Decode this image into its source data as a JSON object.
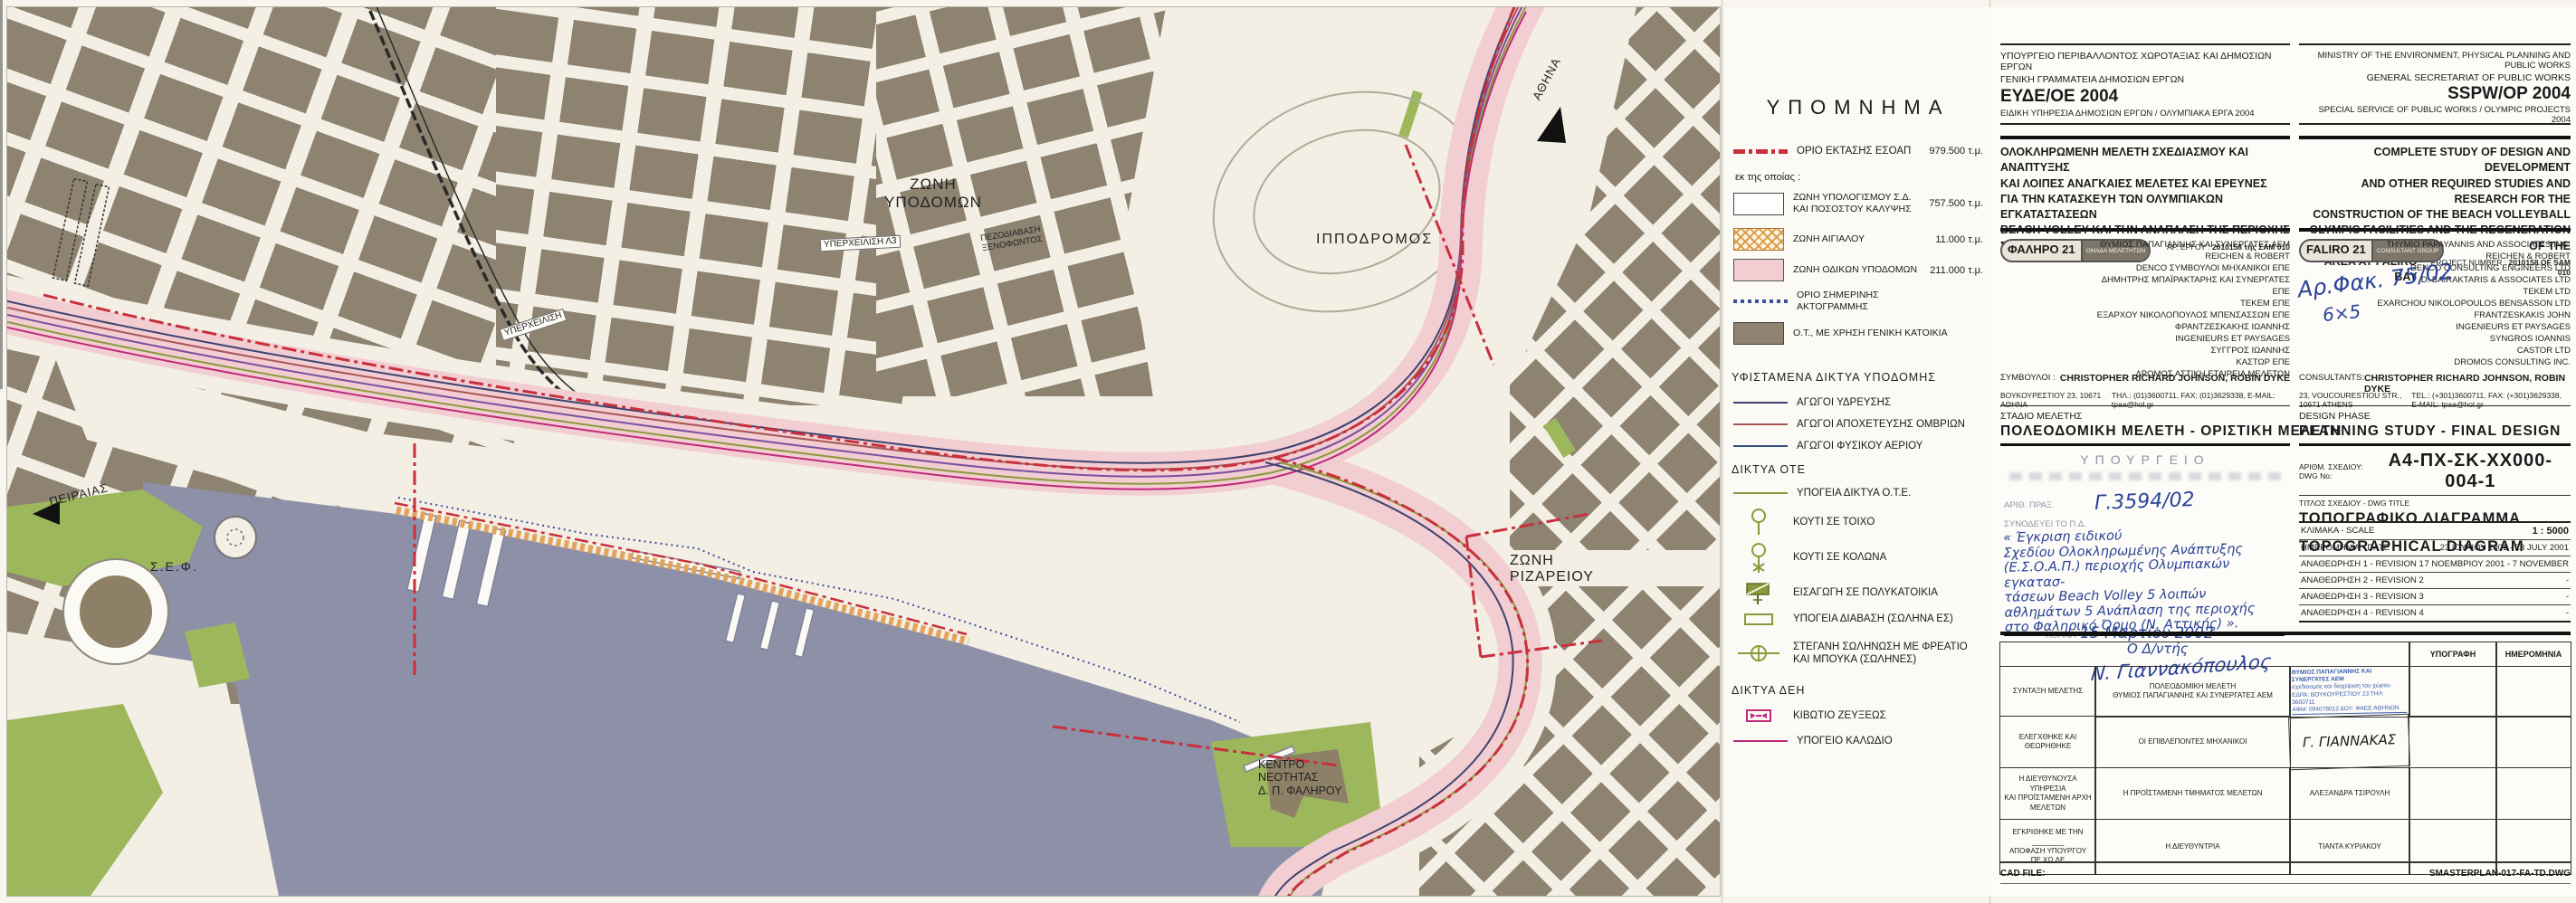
{
  "map": {
    "labels": {
      "zoni_ypodomon": "ΖΩΝΗ\nΥΠΟΔΟΜΩΝ",
      "yperxeilisi_l3": "ΥΠΕΡΧΕΙΛΙΣΗ Λ3",
      "yperxeilisi": "ΥΠΕΡΧΕΙΛΙΣΗ",
      "pezodiavasi": "ΠΕΖΟΔΙΑΒΑΣΗ\nΞΕΝΟΦΩΝΤΟΣ",
      "ippodromos": "ΙΠΠΟΔΡΟΜΟΣ",
      "zoni_rizareiou": "ΖΩΝΗ\nΡΙΖΑΡΕΙΟΥ",
      "kentro_neotitas": "ΚΕΝΤΡΟ\nΝΕΟΤΗΤΑΣ\nΔ. Π. ΦΑΛΗΡΟΥ",
      "sef": "Σ.Ε.Φ.",
      "peiraias": "ΠΕΙΡΑΙΑΣ",
      "athina": "ΑΘΗΝΑ"
    }
  },
  "printing_stamp": {
    "line1": "ΕΘΝΙΚΟ ΤΥΠΟΓΡΑΦΕΙΟ",
    "line2": "Για τεχνικούς λόγους στο σχεδιάγραμμα",
    "line3": "έγινε σμίκρυνση κατά ποσοστό",
    "percent": "54",
    "unit": "%"
  },
  "legend": {
    "title": "ΥΠΟΜΝΗΜΑ",
    "boundary": {
      "label": "ΟΡΙΟ ΕΚΤΑΣΗΣ ΕΣΟΑΠ",
      "value": "979.500 τ.μ."
    },
    "subnote": "εκ της οποίας :",
    "zones": [
      {
        "label": "ΖΩΝΗ ΥΠΟΛΟΓΙΣΜΟΥ Σ.Δ.\nΚΑΙ ΠΟΣΟΣΤΟΥ ΚΑΛΥΨΗΣ",
        "value": "757.500 τ.μ."
      },
      {
        "label": "ΖΩΝΗ ΑΙΓΙΑΛΟΥ",
        "value": "11.000 τ.μ."
      },
      {
        "label": "ΖΩΝΗ ΟΔΙΚΩΝ ΥΠΟΔΟΜΩΝ",
        "value": "211.000 τ.μ."
      },
      {
        "label": "ΟΡΙΟ ΣΗΜΕΡΙΝΗΣ\nΑΚΤΟΓΡΑΜΜΗΣ",
        "value": ""
      },
      {
        "label": "Ο.Τ., ΜΕ ΧΡΗΣΗ ΓΕΝΙΚΗ ΚΑΤΟΙΚΙΑ",
        "value": ""
      }
    ],
    "networks_title": "ΥΦΙΣΤΑΜΕΝΑ ΔΙΚΤΥΑ ΥΠΟΔΟΜΗΣ",
    "networks": [
      "ΑΓΩΓΟΙ ΥΔΡΕΥΣΗΣ",
      "ΑΓΩΓΟΙ ΑΠΟΧΕΤΕΥΣΗΣ ΟΜΒΡΙΩΝ",
      "ΑΓΩΓΟΙ ΦΥΣΙΚΟΥ ΑΕΡΙΟΥ"
    ],
    "ote_title": "ΔΙΚΤΥΑ ΟΤΕ",
    "ote": [
      "ΥΠΟΓΕΙΑ ΔΙΚΤΥΑ Ο.Τ.Ε.",
      "ΚΟΥΤΙ ΣΕ ΤΟΙΧΟ",
      "ΚΟΥΤΙ ΣΕ ΚΟΛΩΝΑ",
      "ΕΙΣΑΓΩΓΗ ΣΕ ΠΟΛΥΚΑΤΟΙΚΙΑ",
      "ΥΠΟΓΕΙΑ ΔΙΑΒΑΣΗ (ΣΩΛΗΝΑ ΕΣ)",
      "ΣΤΕΓΑΝΗ ΣΩΛΗΝΩΣΗ ΜΕ ΦΡΕΑΤΙΟ\nΚΑΙ ΜΠΟΥΚΑ (ΣΩΛΗΝΕΣ)"
    ],
    "deh_title": "ΔΙΚΤΥΑ ΔΕΗ",
    "deh": [
      "ΚΙΒΩΤΙΟ ΖΕΥΞΕΩΣ",
      "ΥΠΟΓΕΙΟ ΚΑΛΩΔΙΟ"
    ]
  },
  "title_block": {
    "greek": {
      "ministry": [
        "ΥΠΟΥΡΓΕΙΟ ΠΕΡΙΒΑΛΛΟΝΤΟΣ ΧΩΡΟΤΑΞΙΑΣ ΚΑΙ ΔΗΜΟΣΙΩΝ ΕΡΓΩΝ",
        "ΓΕΝΙΚΗ ΓΡΑΜΜΑΤΕΙΑ ΔΗΜΟΣΙΩΝ ΕΡΓΩΝ",
        "ΕΥΔΕ/ΟΕ 2004",
        "ΕΙΔΙΚΗ ΥΠΗΡΕΣΙΑ ΔΗΜΟΣΙΩΝ ΕΡΓΩΝ / ΟΛΥΜΠΙΑΚΑ ΕΡΓΑ 2004"
      ],
      "project": [
        "ΟΛΟΚΛΗΡΩΜΕΝΗ ΜΕΛΕΤΗ ΣΧΕΔΙΑΣΜΟΥ ΚΑΙ ΑΝΑΠΤΥΞΗΣ",
        "ΚΑΙ ΛΟΙΠΕΣ ΑΝΑΓΚΑΙΕΣ ΜΕΛΕΤΕΣ ΚΑΙ ΕΡΕΥΝΕΣ",
        "ΓΙΑ ΤΗΝ ΚΑΤΑΣΚΕΥΗ ΤΩΝ ΟΛΥΜΠΙΑΚΩΝ ΕΓΚΑΤΑΣΤΑΣΕΩΝ",
        "BEACH VOLLEY ΚΑΙ ΤΗΝ ΑΝΑΠΛΑΣΗ ΤΗΣ ΠΕΡΙΟΧΗΣ",
        "ΣΤΟ ΦΑΛΗΡΙΚΟ ΟΡΜΟ"
      ],
      "project_no_label": "ΑΡ. ΕΡΓΟΥ :",
      "project_no": "2010158 της ΣΑΜ 010",
      "badge_name": "ΦΑΛΗΡΟ 21",
      "badge_sub": "ΟΜΑΔΑ ΜΕΛΕΤΗΤΩΝ",
      "consultants": [
        "ΘΥΜΙΟΣ ΠΑΠΑΓΙΑΝΝΗΣ ΚΑΙ ΣΥΝΕΡΓΑΤΕΣ ΑΕΜ",
        "REICHEN & ROBERT",
        "DENCO ΣΥΜΒΟΥΛΟΙ ΜΗΧΑΝΙΚΟΙ ΕΠΕ",
        "ΔΗΜΗΤΡΗΣ ΜΠΑΪΡΑΚΤΑΡΗΣ ΚΑΙ ΣΥΝΕΡΓΑΤΕΣ ΕΠΕ",
        "ΤΕΚΕΜ ΕΠΕ",
        "ΕΞΑΡΧΟΥ ΝΙΚΟΛΟΠΟΥΛΟΣ ΜΠΕΝΣΑΣΣΩΝ ΕΠΕ",
        "ΦΡΑΝΤΖΕΣΚΑΚΗΣ ΙΩΑΝΝΗΣ",
        "INGENIEURS ET PAYSAGES",
        "ΣΥΓΓΡΟΣ ΙΩΑΝΝΗΣ",
        "ΚΑΣΤΩΡ ΕΠΕ",
        "ΔΡΟΜΟΣ ΑΣΤΙΚΗ ΕΤΑΙΡΕΙΑ ΜΕΛΕΤΩΝ"
      ],
      "consultants_label": "ΣΥΜΒΟΥΛΟΙ :",
      "consultants_value": "CHRISTOPHER RICHARD JOHNSON, ROBIN DYKE",
      "address": "ΒΟΥΚΟΥΡΕΣΤΙΟΥ 23, 10671 ΑΘΗΝΑ",
      "contact": "ΤΗΛ.: (01)3600711, FAX: (01)3629338, E-MAIL: tpaa@hol.gr",
      "stage_label": "ΣΤΑΔΙΟ ΜΕΛΕΤΗΣ",
      "stage_value": "ΠΟΛΕΟΔΟΜΙΚΗ ΜΕΛΕΤΗ - ΟΡΙΣΤΙΚΗ ΜΕΛΕΤΗ"
    },
    "english": {
      "ministry": [
        "MINISTRY OF THE ENVIRONMENT, PHYSICAL PLANNING AND PUBLIC WORKS",
        "GENERAL SECRETARIAT OF PUBLIC WORKS",
        "SSPW/OP 2004",
        "SPECIAL SERVICE OF PUBLIC WORKS / OLYMPIC PROJECTS 2004"
      ],
      "project": [
        "COMPLETE STUDY OF DESIGN AND DEVELOPMENT",
        "AND OTHER REQUIRED STUDIES AND RESEARCH FOR THE",
        "CONSTRUCTION OF THE BEACH VOLLEYBALL",
        "OLYMPIC FACILITIES AND THE REGENERATION OF THE",
        "AREA AT FALIRO BAY"
      ],
      "project_no_label": "PROJECT NUMBER :",
      "project_no": "2010158 OF SAM 010",
      "badge_name": "FALIRO 21",
      "badge_sub": "CONSULTANT GROUP",
      "consultants": [
        "THYMIO PAPAYANNIS AND ASSOCIATES INC.",
        "REICHEN & ROBERT",
        "DENCO CONSULTING ENGINEERS LTD",
        "D. BAIRAKTARIS & ASSOCIATES LTD",
        "TEKEM LTD",
        "EXARCHOU NIKOLOPOULOS BENSASSON LTD",
        "FRANTZESKAKIS JOHN",
        "INGENIEURS ET PAYSAGES",
        "SYNGROS IOANNIS",
        "CASTOR LTD",
        "DROMOS CONSULTING INC."
      ],
      "consultants_label": "CONSULTANTS:",
      "consultants_value": "CHRISTOPHER RICHARD JOHNSON, ROBIN DYKE",
      "address": "23, VOUCOURESTIOU STR., 10671 ATHENS",
      "contact": "TEL.: (+301)3600711, FAX: (+301)3629338, E-MAIL: tpaa@hol.gr",
      "phase_label": "DESIGN PHASE",
      "phase_value": "PLANNING STUDY - FINAL DESIGN"
    }
  },
  "annotations": {
    "file_no": "Αρ.Φακ. 75/02",
    "file_note": "6×5"
  },
  "approval": {
    "stamp_title": "ΥΠΟΥΡΓΕΙΟ",
    "praxis_label": "ΑΡΙΘ. ΠΡΑΞ.",
    "praxis_no": "Γ.3594/02",
    "synodeuei_label": "ΣΥΝΟΔΕΥΕΙ ΤΟ Π.Δ.",
    "lines": [
      "« Έγκριση ειδικού",
      "Σχεδίου Ολοκληρωμένης Ανάπτυξης",
      "(Ε.Σ.Ο.Α.Π.) περιοχής Ολυμπιακών εγκατασ-",
      "τάσεων Beach Volley 5 λοιπών",
      "αθλημάτων 5 Ανάπλαση της περιοχής",
      "στο Φαληρικό Όρμο (Ν. Αττικής) »."
    ],
    "city_label": "ΑΘΗΝΑ",
    "date_hand": "15  Μαρτίου",
    "year": "2002",
    "director": "Ο  Δ/ντής",
    "signature": "Ν. Γιαννακόπουλος"
  },
  "drawing": {
    "no_label_gr": "ΑΡΙΘΜ. ΣΧΕΔΙΟΥ:",
    "no_label_en": "DWG No:",
    "number": "Α4-ΠΧ-ΣΚ-ΧΧ000-004-1",
    "title_label": "ΤΙΤΛΟΣ ΣΧΕΔΙΟΥ - DWG TITLE",
    "title_gr": "ΤΟΠΟΓΡΑΦΙΚΟ  ΔΙΑΓΡΑΜΜΑ",
    "title_en": "TOPOGRAPHICAL  DIAGRAM",
    "rows": [
      {
        "label": "ΚΛΙΜΑΚΑ - SCALE",
        "value": "1 : 5000"
      },
      {
        "label": "ΗΜΕΡΟΜΗΝΙΑ - DATE",
        "value": "23 ΙΟΥΛΙΟΥ 2001 - 23 JULY 2001"
      },
      {
        "label": "ΑΝΑΘΕΩΡΗΣΗ 1 - REVISION 1",
        "value": "7 ΝΟΕΜΒΡΙΟΥ 2001 - 7 NOVEMBER"
      },
      {
        "label": "ΑΝΑΘΕΩΡΗΣΗ 2 - REVISION 2",
        "value": "-"
      },
      {
        "label": "ΑΝΑΘΕΩΡΗΣΗ 3 - REVISION 3",
        "value": "-"
      },
      {
        "label": "ΑΝΑΘΕΩΡΗΣΗ 4 - REVISION 4",
        "value": "-"
      }
    ]
  },
  "sign_table": {
    "col_signature": "ΥΠΟΓΡΑΦΗ",
    "col_date": "ΗΜΕΡΟΜΗΝΙΑ",
    "rows": [
      {
        "label": "ΣΥΝΤΑΞΗ ΜΕΛΕΤΗΣ",
        "role": "ΠΟΛΕΟΔΟΜΙΚΗ ΜΕΛΕΤΗ\nΘΥΜΙΟΣ ΠΑΠΑΓΙΑΝΝΗΣ ΚΑΙ ΣΥΝΕΡΓΑΤΕΣ ΑΕΜ",
        "name": ""
      },
      {
        "label": "ΕΛΕΓΧΘΗΚΕ ΚΑΙ ΘΕΩΡΗΘΗΚΕ",
        "role": "ΟΙ ΕΠΙΒΛΕΠΟΝΤΕΣ ΜΗΧΑΝΙΚΟΙ",
        "name": "Γ. ΓΙΑΝΝΑΚΑΣ"
      },
      {
        "label": "Η ΔΙΕΥΘΥΝΟΥΣΑ ΥΠΗΡΕΣΙΑ\nΚΑΙ ΠΡΟΪΣΤΑΜΕΝΗ ΑΡΧΗ\nΜΕΛΕΤΩΝ",
        "role": "Η ΠΡΟΪΣΤΑΜΕΝΗ ΤΜΗΜΑΤΟΣ ΜΕΛΕΤΩΝ",
        "name": "ΑΛΕΞΑΝΔΡΑ ΤΣΙΡΟΥΛΗ"
      },
      {
        "label": "ΕΓΚΡΙΘΗΚΕ ΜΕ ΤΗΝ ________\nΑΠΟΦΑΣΗ ΥΠΟΥΡΓΟΥ\nΠΕ.ΧΩ.ΔΕ",
        "role": "Η ΔΙΕΥΘΥΝΤΡΙΑ",
        "name": "ΤΙΑΝΤΑ ΚΥΡΙΑΚΟΥ"
      }
    ],
    "stamp": [
      "ΘΥΜΙΟΣ ΠΑΠΑΓΙΑΝΝΗΣ ΚΑΙ ΣΥΝΕΡΓΑΤΕΣ ΑΕΜ",
      "σχεδιασμός και διαχείριση του χώρου",
      "ΕΔΡΑ: ΒΟΥΚΟΥΡΕΣΤΙΟΥ 23   ΤΗΛ: 3600711",
      "ΑΦΜ: 094078012    ΔΟΥ: ΦΑΕΕ ΑΘΗΝΩΝ"
    ]
  },
  "cad": {
    "label": "CAD FILE:",
    "value": "SMASTERPLAN-017-FA-TD.DWG"
  },
  "colors": {
    "sea": "#8d90a7",
    "blocks": "#8e8371",
    "green": "#9db75d",
    "road_zone_pink": "#f2cdd2",
    "boundary_red": "#c8303c",
    "shore_hatch_orange": "#e2a35c",
    "coastline_blue": "#3a4f9e",
    "water_pipe": "#3c4470",
    "storm_sewer": "#a85555",
    "gas_pipe": "#33507c",
    "ote_olive": "#8a9a3a",
    "deh_magenta": "#bf2a7a",
    "stamp_blue": "#3a5fae",
    "handwriting_blue": "#2b4397"
  }
}
